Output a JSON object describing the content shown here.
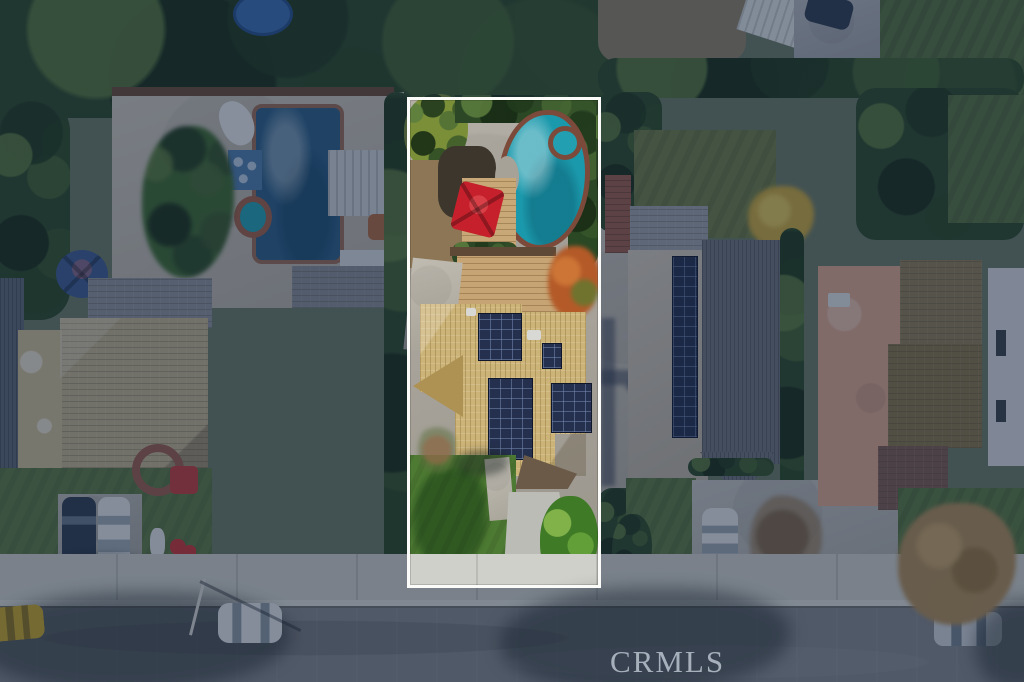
{
  "meta": {
    "type": "aerial-photograph",
    "subject": "overhead-drone-view-of-suburban-street-with-highlighted-listing-lot"
  },
  "watermark": {
    "text": "CRMLS"
  },
  "highlight": {
    "shape": "rectangle",
    "border_color": "#fbfbf9",
    "dim_overlay_color": "rgba(17,33,62,0.45)"
  },
  "colors": {
    "pool_water_teal": "#1b99ac",
    "pool_coping_brick": "#7c4a3a",
    "spa_water": "#22a0b2",
    "red_umbrella": "#c5202c",
    "wood_deck": "#c8a876",
    "plank_patio": "#c7a474",
    "featured_roof_tan": "#ccb377",
    "roof_gable_shade": "#ae9254",
    "solar_panel_navy": "#25304e",
    "lawn_green": "#4e7b33",
    "lawn_shadow": "rgba(18,56,18,0.5)",
    "driveway_gray": "#bcbcb6",
    "backyard_concrete": "#a7a298",
    "dirt_brown": "#8c7656",
    "autumn_orange_tree": "#b35a28",
    "neighbor_pool_blue": "#2a5d85",
    "spa_ring_brick": "#a06048",
    "tile_mat_blue": "#4e7cab",
    "boat_white": "#e8eaea",
    "patio_cover_white": "#ccd2d6",
    "blue_umbrella": "#3c5c90",
    "left_roof_tan": "#c2b38c",
    "left_flat_roof": "#cdbd96",
    "gray_roof": "#8e939a",
    "corrugated_gray": "#5e6974",
    "brick_red_path": "#9a5e4c",
    "play_structure_red": "#c23c3c",
    "right_ridged_roof_gray": "#70747b",
    "right_flat_roof_beige": "#c9c0ae",
    "shed_roof_gray": "#9ba1a7",
    "olive_lawn": "#6f7e46",
    "yellow_tree": "#c9a93c",
    "salmon_roof": "#dca88c",
    "brown_shingle_roof": "#8d7c55",
    "dark_red_roof": "#7d5c4e",
    "white_house": "#d9dbde",
    "autumn_canopy_tan": "#b08d58",
    "tree_canopy_green": "#2c4726",
    "trampoline_blue": "#3a6eb0",
    "sidewalk": "#cfd0c9",
    "curb": "#dcddd7",
    "asphalt_road": "#83878a",
    "car_yellow": "#c9a72b",
    "car_white": "#e3e6e8",
    "car_silver": "#cfd4d8",
    "car_dark": "#2e3c4e",
    "watermark_gray": "#c6cfda"
  },
  "objects": {
    "featured_lot": [
      "freeform-pool",
      "spa",
      "red-umbrella",
      "wood-deck",
      "plank-patio",
      "tan-tile-roof-house",
      "four-solar-arrays",
      "front-lawn",
      "driveway",
      "tropical-plants"
    ],
    "left_neighbor": [
      "rectangular-pool",
      "round-spa",
      "blue-tile-mat",
      "white-boat",
      "palm-tree",
      "patio-cover",
      "blue-umbrella",
      "tan-shingle-roof",
      "brick-circle-path",
      "red-play-set",
      "driveway-with-two-cars"
    ],
    "right_neighbor": [
      "olive-back-lawn",
      "shed",
      "flat-roof-with-solar-strip",
      "dark-ridged-roof",
      "shared-driveway",
      "white-car",
      "bare-brown-tree"
    ],
    "far_right_neighbor": [
      "salmon-flat-roof",
      "brown-shingle-roof",
      "white-house-wall",
      "autumn-street-tree",
      "parked-silver-car"
    ],
    "street": [
      "sidewalk",
      "curb",
      "asphalt-road",
      "tree-shadows",
      "yellow-parked-car",
      "white-parked-car",
      "lamp-post"
    ],
    "top_area": [
      "dense-tree-canopy",
      "blue-trampoline",
      "gravel-yard",
      "white-ridge-roof",
      "rear-driveway-with-car",
      "hedge-row"
    ]
  }
}
